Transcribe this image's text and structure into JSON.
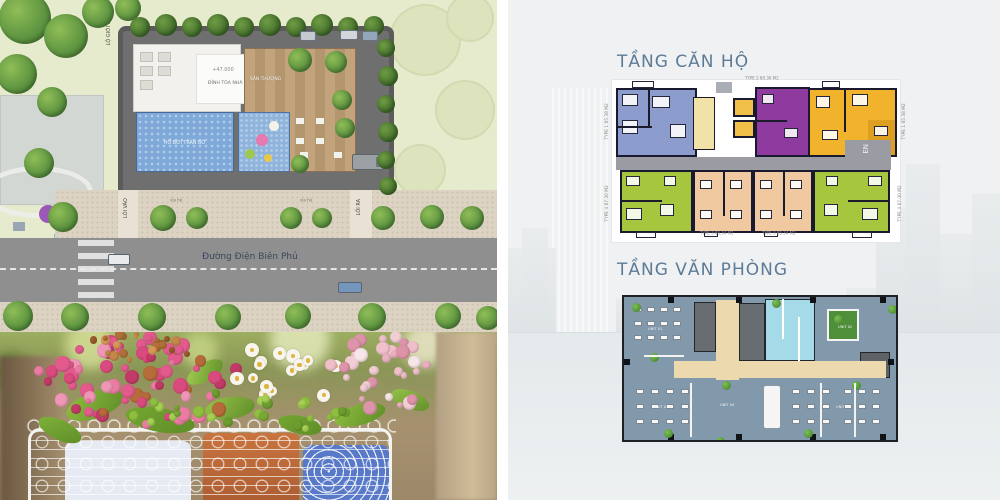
{
  "site_plan": {
    "boundary_label": "LỘ GIỚI 30M",
    "building_elevation": "+47.000",
    "building_label": "ĐỈNH TÒA NHÀ",
    "pool_label": "HỒ BƠI TRÀN BỜ",
    "terrace_label": "SÂN THƯỢNG",
    "entrance_label": "LỐI VÀO",
    "exit_label": "LỐI RA",
    "sidewalk_label": "vỉa hè",
    "street_name": "Đường Điện Biên Phủ"
  },
  "floor_plans": {
    "apartments": {
      "title": "TẦNG CĂN HỘ",
      "top_unit_label": "TYPE 2  80.36 M2",
      "bottom_left_unit_label": "TYPE 3  85.34 M2",
      "bottom_right_unit_label": "TYPE 3  85.34 M2",
      "left_top_side_label": "TYPE 1  85.38 M2",
      "right_top_side_label": "TYPE 1  85.38 M2",
      "left_bottom_side_label": "TYPE 4  87.30 M2",
      "right_bottom_side_label": "TYPE 4  87.30 M2",
      "stair_label": "EN"
    },
    "offices": {
      "title": "TẦNG VĂN PHÒNG",
      "unit_labels": [
        "UNIT 01",
        "UNIT 02",
        "UNIT 03",
        "UNIT 04",
        "UNIT 05"
      ]
    }
  },
  "colors": {
    "title_text": "#5d7b97",
    "unit_blue": "#8c9ccd",
    "unit_purple": "#8e3a9e",
    "unit_yellow": "#f1b32c",
    "unit_green": "#a6c73d",
    "unit_peach": "#f1c9a1",
    "pool_blue": "#7fa9d8",
    "office_floor": "#8298ab",
    "office_corridor": "#ecd9ad",
    "office_cyan": "#a5dbe8"
  }
}
